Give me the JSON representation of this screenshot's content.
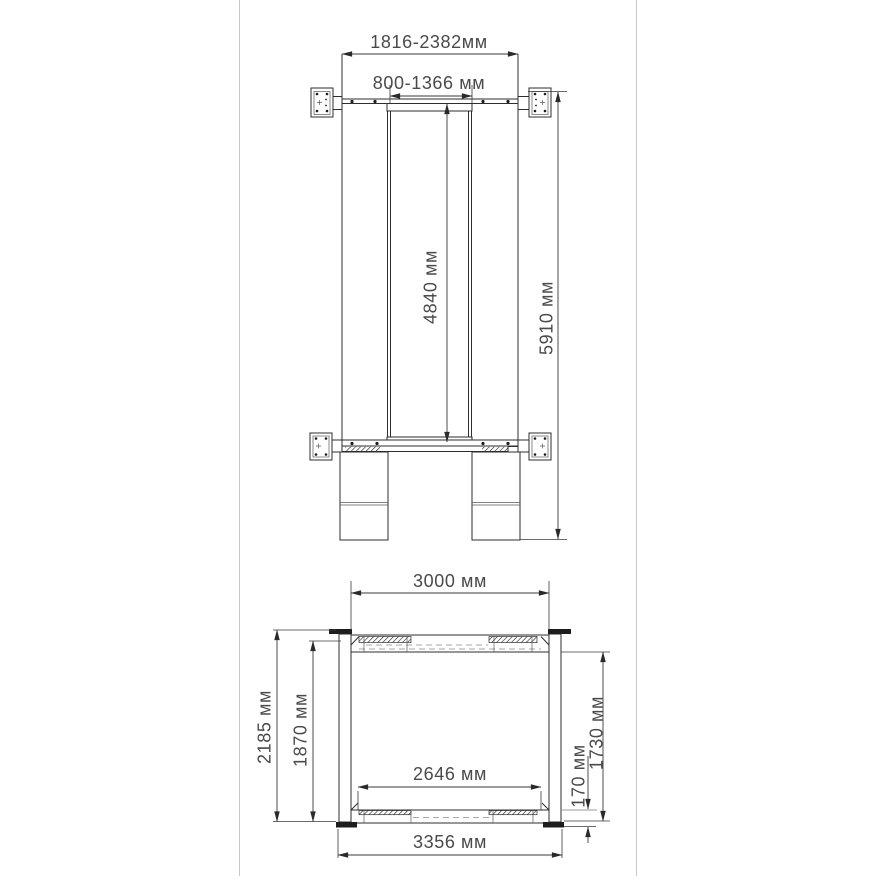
{
  "page": {
    "background_color": "#ffffff",
    "frame_border_color": "#c9c9c9",
    "line_color": "#2e2e2e",
    "text_color": "#4a4a4a"
  },
  "top_view": {
    "labels": {
      "width_overall": "1816-2382мм",
      "carriage_width": "800-1366 мм",
      "inner_length": "4840 мм",
      "overall_length": "5910 мм"
    }
  },
  "front_view": {
    "labels": {
      "top_width": "3000 мм",
      "overall_height": "2185 мм",
      "clearance_height": "1870 мм",
      "under_beam_clearance": "1730 мм",
      "base_height": "170 мм",
      "inner_width": "2646 мм",
      "overall_width": "3356 мм"
    }
  }
}
